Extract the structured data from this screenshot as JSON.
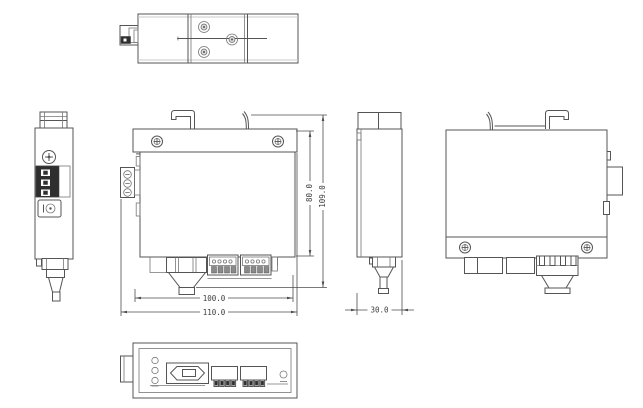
{
  "dimensions": {
    "front_width_inner": "100.0",
    "front_width_outer": "110.0",
    "front_height_body": "80.0",
    "front_height_total": "109.0",
    "side_depth": "30.0"
  },
  "colors": {
    "background": "#ffffff",
    "line": "#555555",
    "dark_fill": "#2e2e2e",
    "dim_text": "#3d3d3d"
  }
}
